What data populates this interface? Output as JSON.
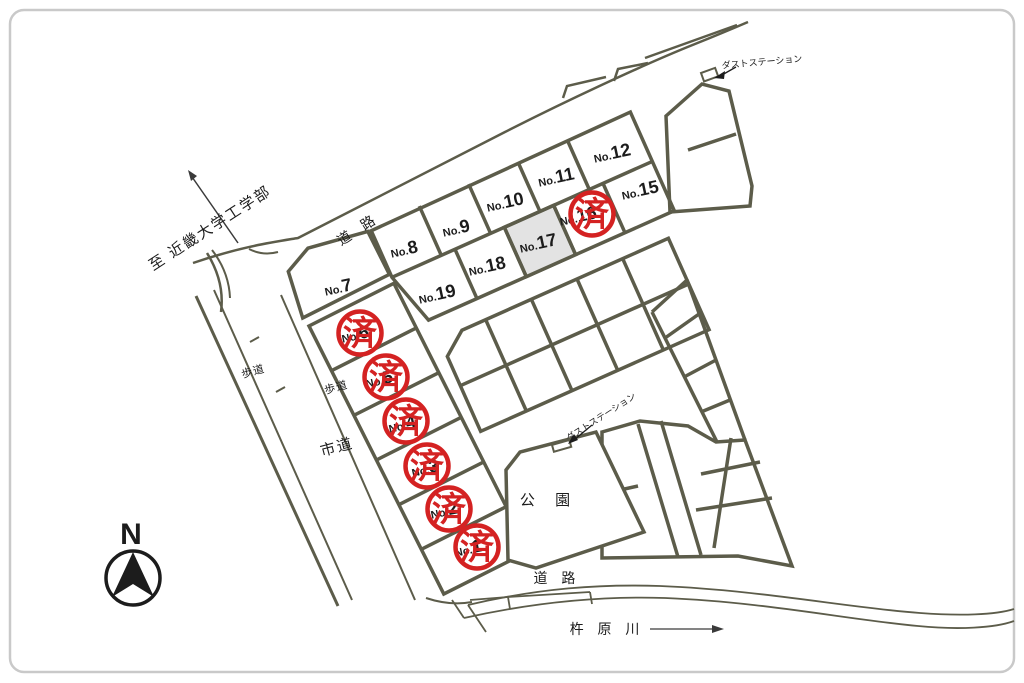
{
  "map": {
    "sold_stamp": "済",
    "colors": {
      "line": "#5c5c4a",
      "stamp_red": "#d42222",
      "shaded_lot_fill": "#e3e3e3",
      "frame": "#c9c9c9"
    },
    "labels": {
      "destination": "至 近畿大学工学部",
      "road_top": "道 路",
      "road_bottom": "道 路",
      "city_road": "市道",
      "sidewalk": "歩道",
      "park": "公 園",
      "dust_station": "ダストステーション",
      "river": "杵 原 川",
      "compass_north": "N"
    },
    "lots": [
      {
        "prefix": "No.",
        "number": "1",
        "sold": true
      },
      {
        "prefix": "No.",
        "number": "2",
        "sold": true
      },
      {
        "prefix": "No.",
        "number": "3",
        "sold": true
      },
      {
        "prefix": "No.",
        "number": "4",
        "sold": true
      },
      {
        "prefix": "No.",
        "number": "5",
        "sold": true
      },
      {
        "prefix": "No.",
        "number": "6",
        "sold": true
      },
      {
        "prefix": "No.",
        "number": "7",
        "sold": false
      },
      {
        "prefix": "No.",
        "number": "8",
        "sold": false
      },
      {
        "prefix": "No.",
        "number": "9",
        "sold": false
      },
      {
        "prefix": "No.",
        "number": "10",
        "sold": false
      },
      {
        "prefix": "No.",
        "number": "11",
        "sold": false
      },
      {
        "prefix": "No.",
        "number": "12",
        "sold": false
      },
      {
        "prefix": "No.",
        "number": "15",
        "sold": false
      },
      {
        "prefix": "No.",
        "number": "16",
        "sold": true
      },
      {
        "prefix": "No.",
        "number": "17",
        "sold": false,
        "shaded": true
      },
      {
        "prefix": "No.",
        "number": "18",
        "sold": false
      },
      {
        "prefix": "No.",
        "number": "19",
        "sold": false
      }
    ]
  }
}
